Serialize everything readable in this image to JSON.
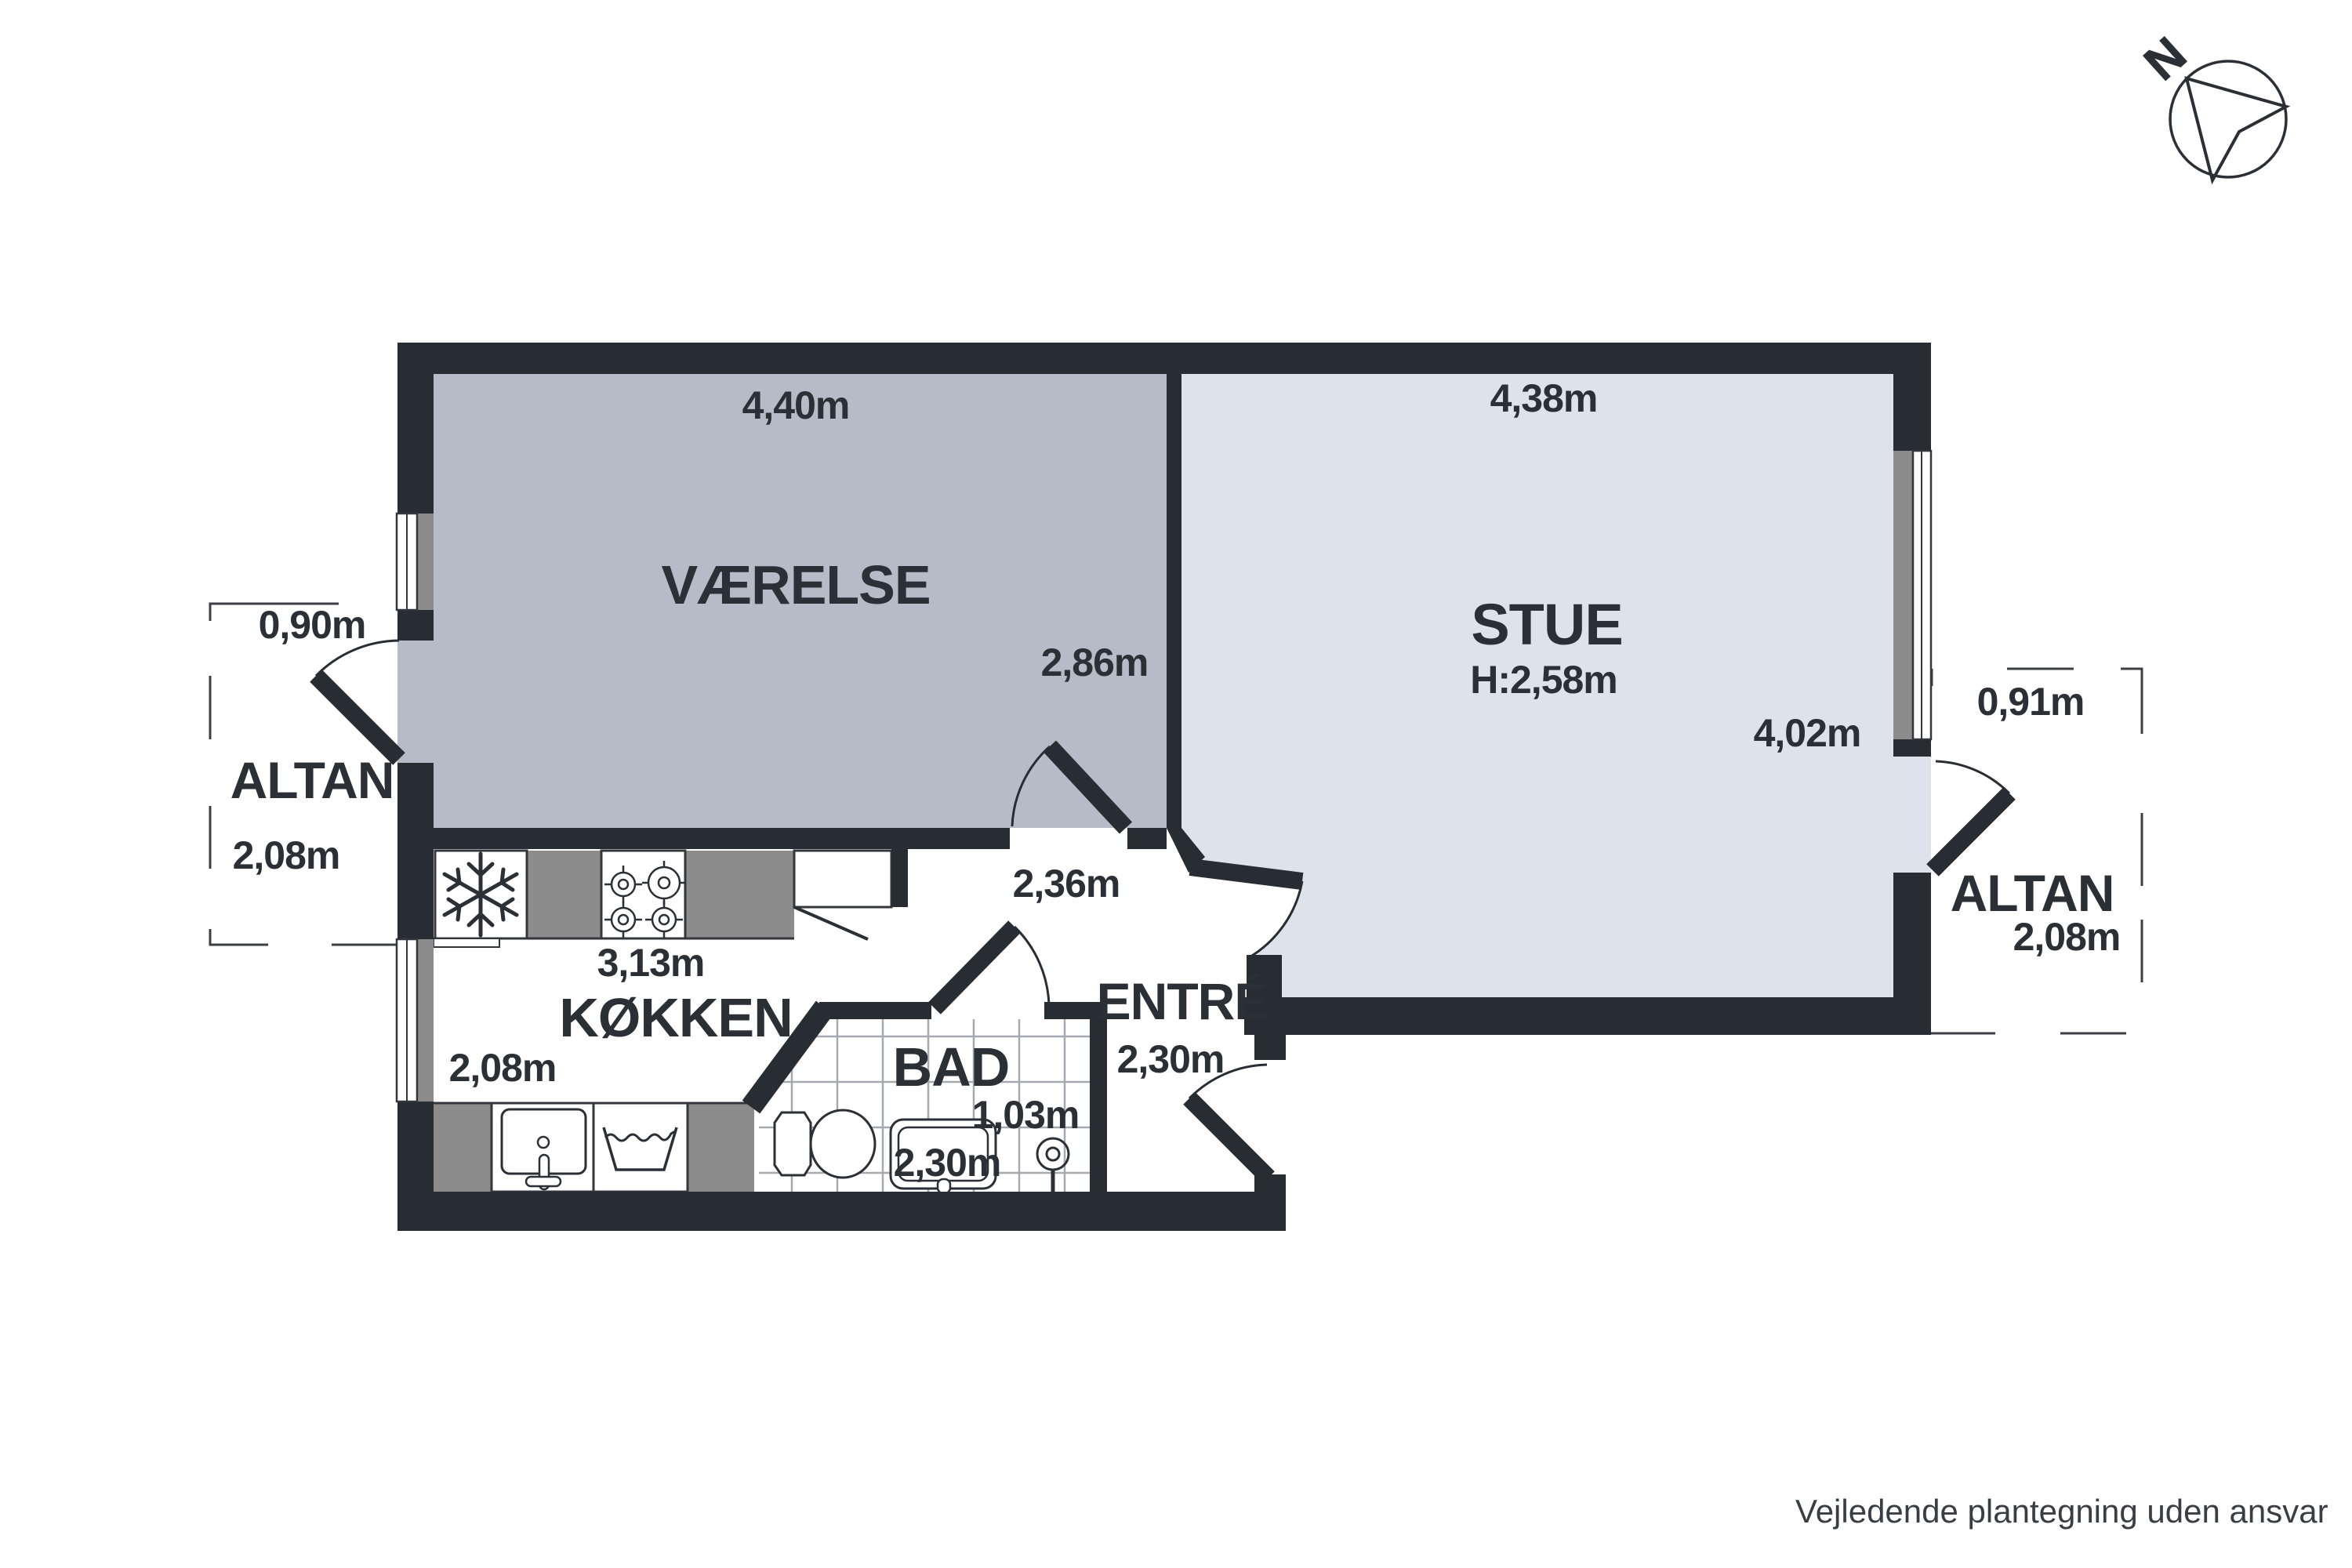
{
  "title": "Apartment floor plan (plantegning)",
  "rooms": {
    "vaerelse": {
      "name": "VÆRELSE",
      "width": "4,40m",
      "depth": "2,86m"
    },
    "stue": {
      "name": "STUE",
      "ceiling_height": "H:2,58m",
      "width": "4,38m",
      "depth": "4,02m"
    },
    "koekken": {
      "name": "KØKKEN",
      "width": "3,13m",
      "depth": "2,08m"
    },
    "bad": {
      "name": "BAD",
      "width": "1,03m",
      "depth": "2,30m"
    },
    "entre": {
      "name": "ENTRÉ",
      "width": "2,36m",
      "depth": "2,30m"
    }
  },
  "balconies": {
    "left": {
      "name": "ALTAN",
      "width": "0,90m",
      "depth": "2,08m"
    },
    "right": {
      "name": "ALTAN",
      "width": "0,91m",
      "depth": "2,08m"
    }
  },
  "compass": {
    "label": "N"
  },
  "footer": {
    "disclaimer": "Vejledende plantegning uden ansvar"
  },
  "icons": [
    "north-arrow-icon",
    "fridge-snowflake-icon",
    "stove-burners-icon",
    "kitchen-sink-icon",
    "washing-machine-icon",
    "toilet-icon",
    "bathroom-sink-icon",
    "shower-drain-icon"
  ],
  "colors": {
    "wall": "#282c33",
    "room_vaerelse_fill": "#b6bcc7",
    "room_stue_fill": "#dde2eb",
    "counter_gray": "#8c8c8c",
    "tile_grid": "#a6aab0",
    "dimension_line": "#3b3f45",
    "text": "#2b2f36",
    "background": "#ffffff"
  }
}
